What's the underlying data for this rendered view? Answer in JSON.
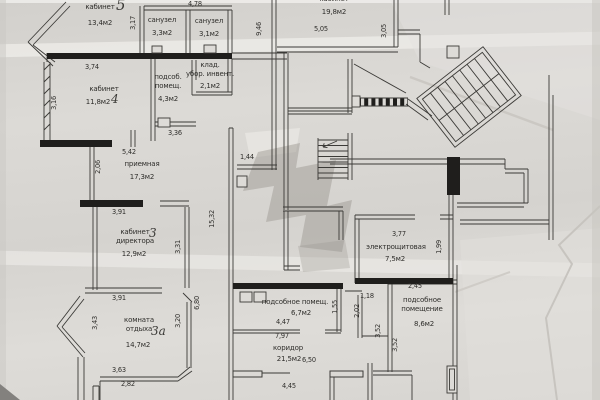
{
  "document": {
    "kind": "floor plan (photographed technical drawing)",
    "language": "ru",
    "paper_color": "#d8d6d2",
    "line_color": "#3b3a37"
  },
  "rooms": [
    {
      "name": "кабинет",
      "number": "5",
      "area": "13,4м2"
    },
    {
      "name": "санузел",
      "area": "3,3м2"
    },
    {
      "name": "санузел",
      "area": "3,1м2"
    },
    {
      "name": "кабинет",
      "number": "4",
      "area": "11,8м2"
    },
    {
      "name": "подсоб.\nпомещ.",
      "area": "4,3м2"
    },
    {
      "name": "клад.\nубор. инвент.",
      "area": "2,1м2"
    },
    {
      "name": "кабинет",
      "area": "19,8м2"
    },
    {
      "name": "приемная",
      "area": "17,3м2"
    },
    {
      "name": "кабинет\nдиректора",
      "number": "3",
      "area": "12,9м2"
    },
    {
      "name": "комната\nотдыха",
      "number": "3а",
      "area": "14,7м2"
    },
    {
      "name": "электрощитовая",
      "area": "7,5м2"
    },
    {
      "name": "подсобное помещ.",
      "area": "6,7м2"
    },
    {
      "name": "подсобное\nпомещение",
      "area": "8,6м2"
    },
    {
      "name": "коридор",
      "area": "21,5м2"
    }
  ],
  "dims": {
    "d478": "4,78",
    "d317": "3,17",
    "d946": "9,46",
    "d305": "3,05",
    "d505": "5,05",
    "d374": "3,74",
    "d316": "3,16",
    "d336": "3,36",
    "d542": "5,42",
    "d206": "2,06",
    "d144": "1,44",
    "d391a": "3,91",
    "d391b": "3,91",
    "d1532": "15,32",
    "d331": "3,31",
    "d343": "3,43",
    "d320": "3,20",
    "d680": "6,80",
    "d363": "3,63",
    "d282": "2,82",
    "d377": "3,77",
    "d199": "1,99",
    "d245": "2,45",
    "d118": "1,18",
    "d202": "2,02",
    "d352a": "3,52",
    "d352b": "3,52",
    "d155": "1,55",
    "d447": "4,47",
    "d797": "7,97",
    "d650": "6,50",
    "d445": "4,45"
  }
}
